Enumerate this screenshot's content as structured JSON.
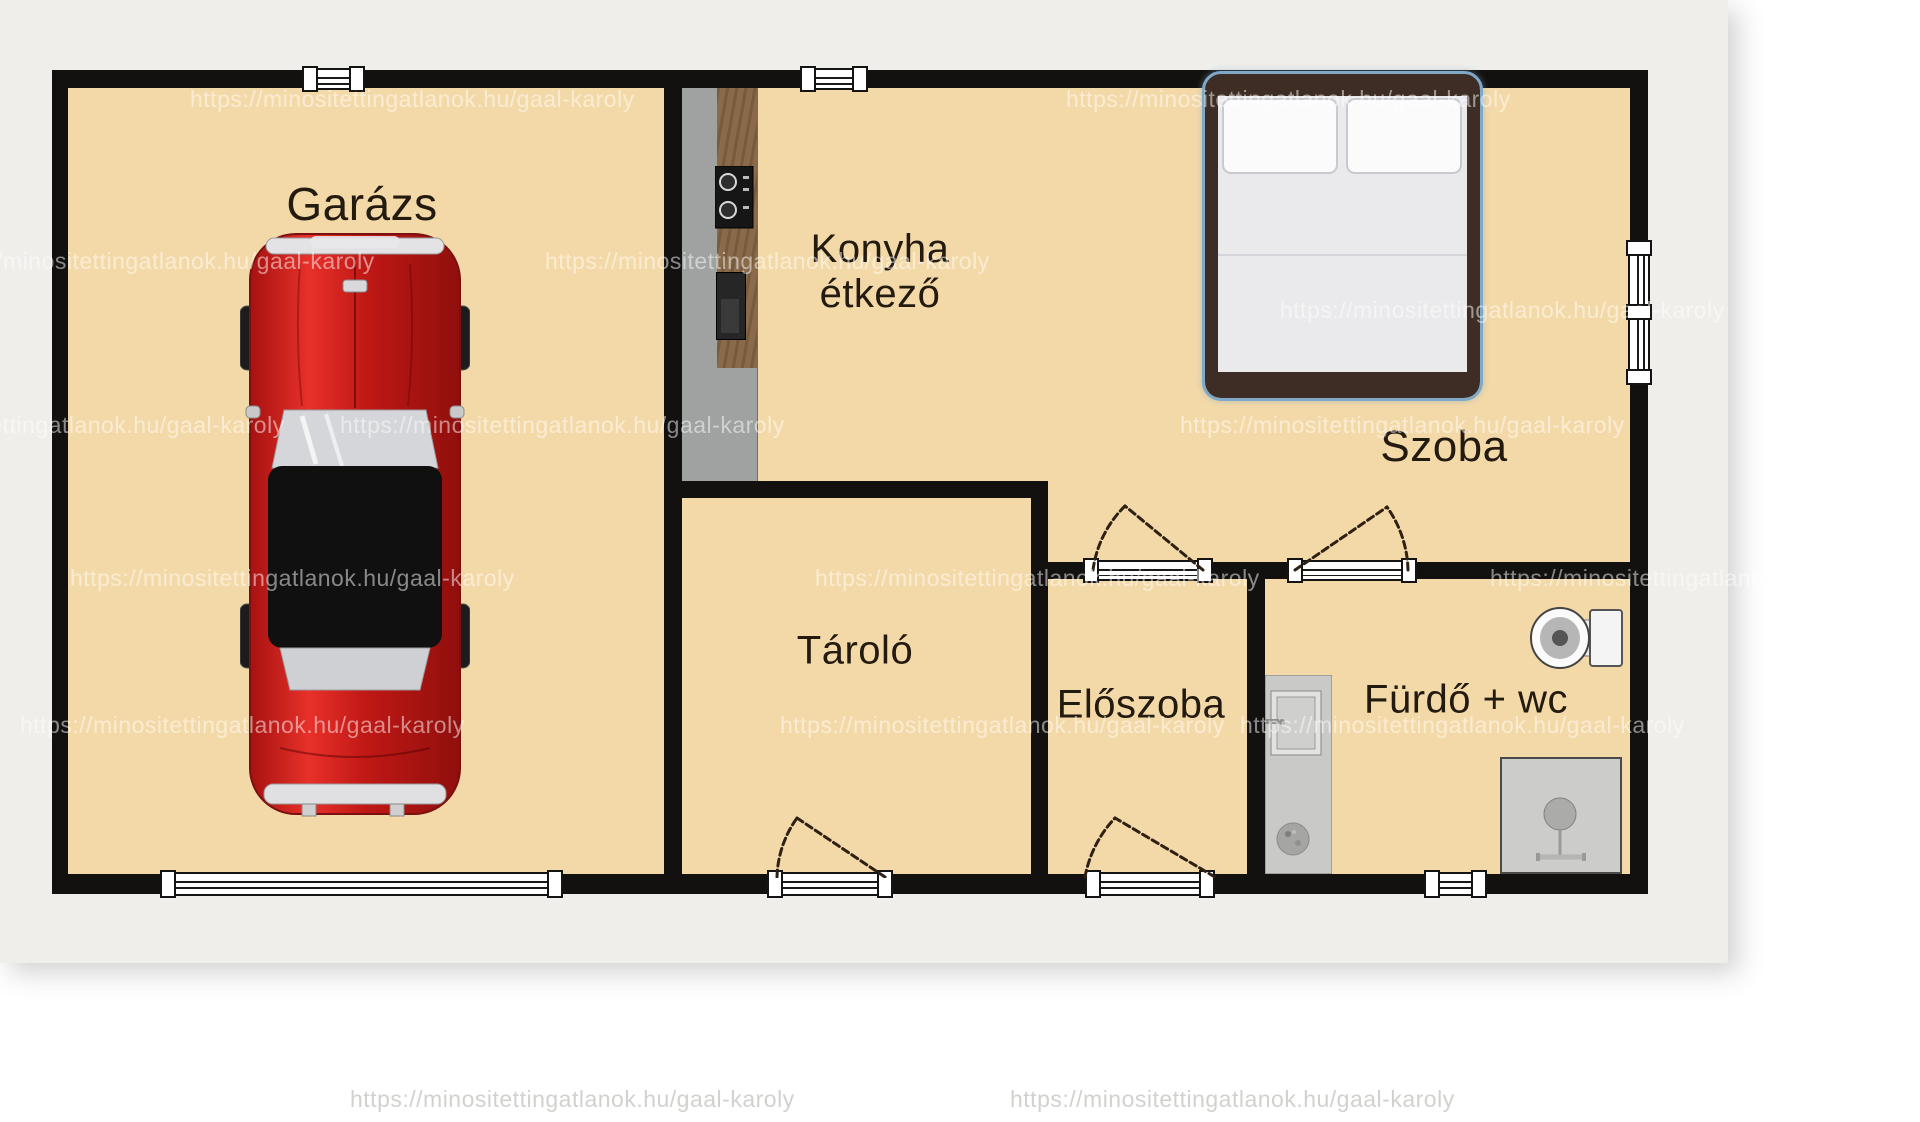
{
  "canvas": {
    "width": 1920,
    "height": 1122
  },
  "colors": {
    "page_bg": "#efeeea",
    "page_white": "#ffffff",
    "floor": "#f4d9a8",
    "wall": "#131110",
    "label": "#231a10",
    "counter_gray": "#a0a1a1",
    "counter_wood": "#8a6a48",
    "bed_frame": "#3d2d24",
    "bed_mattress": "#eaeaec",
    "bed_outline": "#7fa9c7",
    "car_red": "#cf1d1b",
    "fixture_gray": "#c9c9c7",
    "watermark": "#ffffff"
  },
  "rooms": {
    "garage": {
      "label": "Garázs"
    },
    "kitchen": {
      "label_line1": "Konyha",
      "label_line2": "étkező"
    },
    "bedroom": {
      "label": "Szoba"
    },
    "storage": {
      "label": "Tároló"
    },
    "hall": {
      "label": "Előszoba"
    },
    "bath": {
      "label": "Fürdő + wc"
    }
  },
  "icons": {
    "car": "car-icon",
    "bed": "bed-icon",
    "stove": "stove-icon",
    "toilet": "toilet-icon",
    "washbasin": "washbasin-icon",
    "shower": "shower-icon"
  },
  "watermark": {
    "text": "https://minositettingatlanok.hu/gaal-karoly",
    "positions": [
      {
        "x": 190,
        "y": 86
      },
      {
        "x": 1066,
        "y": 86
      },
      {
        "x": -70,
        "y": 248
      },
      {
        "x": 545,
        "y": 248
      },
      {
        "x": 1280,
        "y": 297
      },
      {
        "x": -160,
        "y": 412
      },
      {
        "x": 340,
        "y": 412
      },
      {
        "x": 1180,
        "y": 412
      },
      {
        "x": 70,
        "y": 565
      },
      {
        "x": 815,
        "y": 565
      },
      {
        "x": 1490,
        "y": 565
      },
      {
        "x": 20,
        "y": 712
      },
      {
        "x": 780,
        "y": 712
      },
      {
        "x": 1240,
        "y": 712
      },
      {
        "x": 350,
        "y": 1086,
        "dark": true
      },
      {
        "x": 1010,
        "y": 1086,
        "dark": true
      }
    ]
  }
}
